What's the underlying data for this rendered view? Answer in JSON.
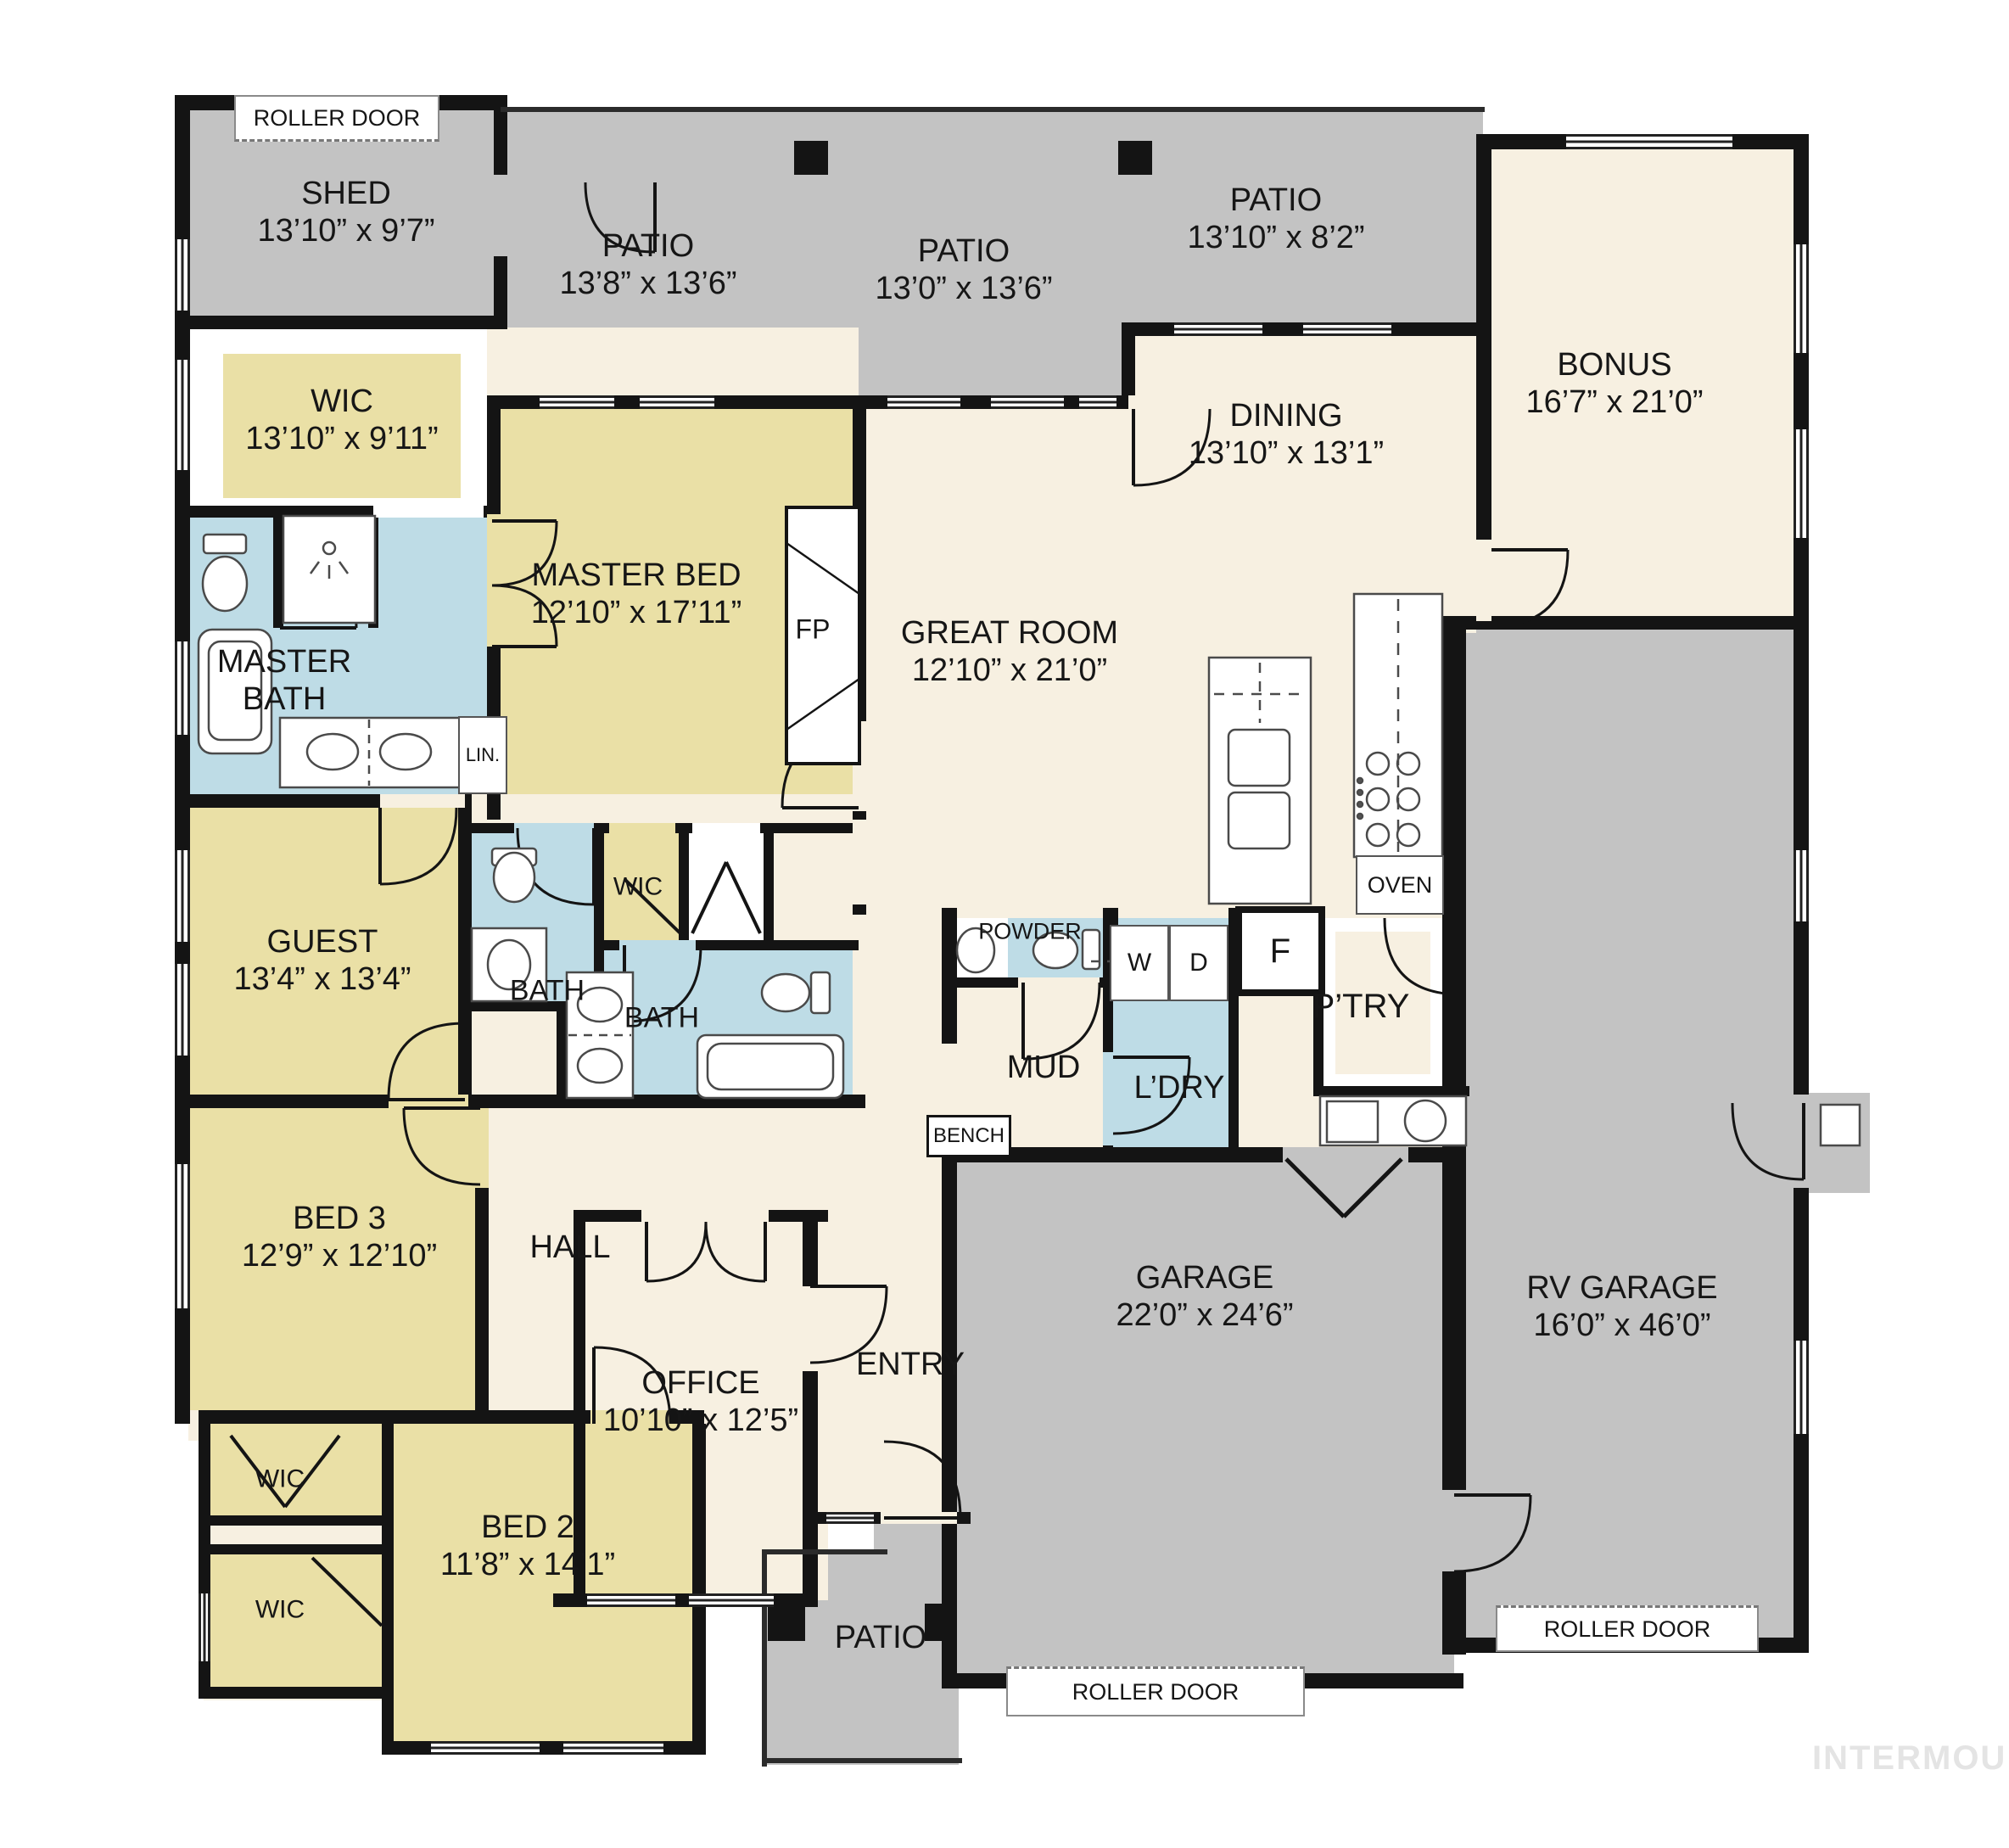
{
  "meta": {
    "watermark": "INTERMOUNTAIN"
  },
  "rooms": {
    "shed": {
      "name": "SHED",
      "dims": "13’10” x 9’7”"
    },
    "patio_nw": {
      "name": "PATIO",
      "dims": "13’8” x 13’6”"
    },
    "patio_n": {
      "name": "PATIO",
      "dims": "13’0” x 13’6”"
    },
    "patio_ne": {
      "name": "PATIO",
      "dims": "13’10” x 8’2”"
    },
    "bonus": {
      "name": "BONUS",
      "dims": "16’7” x 21’0”"
    },
    "dining": {
      "name": "DINING",
      "dims": "13’10” x 13’1”"
    },
    "great_room": {
      "name": "GREAT ROOM",
      "dims": "12’10” x 21’0”"
    },
    "master_bed": {
      "name": "MASTER BED",
      "dims": "12’10” x 17’11”"
    },
    "master_wic": {
      "name": "WIC",
      "dims": "13’10” x 9’11”"
    },
    "master_bath": {
      "name": "MASTER BATH"
    },
    "guest": {
      "name": "GUEST",
      "dims": "13’4” x 13’4”"
    },
    "bath_guest": {
      "name": "BATH"
    },
    "wic_hall": {
      "name": "WIC"
    },
    "bath_hall": {
      "name": "BATH"
    },
    "bed3": {
      "name": "BED 3",
      "dims": "12’9” x 12’10”"
    },
    "hall": {
      "name": "HALL"
    },
    "office": {
      "name": "OFFICE",
      "dims": "10’10” x 12’5”"
    },
    "entry": {
      "name": "ENTRY"
    },
    "bed2": {
      "name": "BED 2",
      "dims": "11’8” x 14’1”"
    },
    "wic_bed3": {
      "name": "WIC"
    },
    "wic_bed2": {
      "name": "WIC"
    },
    "patio_front": {
      "name": "PATIO"
    },
    "garage": {
      "name": "GARAGE",
      "dims": "22’0” x 24’6”"
    },
    "rv_garage": {
      "name": "RV GARAGE",
      "dims": "16’0” x 46’0”"
    },
    "powder": {
      "name": "POWDER"
    },
    "mud": {
      "name": "MUD"
    },
    "laundry": {
      "name": "L’DRY"
    },
    "pantry": {
      "name": "P’TRY"
    }
  },
  "fixtures": {
    "fireplace": "FP",
    "linen": "LIN.",
    "oven": "OVEN",
    "bench": "BENCH",
    "washer": "W",
    "dryer": "D",
    "fridge": "F"
  },
  "doors": {
    "roller_shed": "ROLLER DOOR",
    "roller_garage": "ROLLER DOOR",
    "roller_rv": "ROLLER DOOR"
  },
  "colors": {
    "patio_gray": "#c3c3c3",
    "living_cream": "#f7f0e1",
    "bedroom_yellow": "#eae0a6",
    "bath_blue": "#bedce6",
    "wall_black": "#141414"
  }
}
